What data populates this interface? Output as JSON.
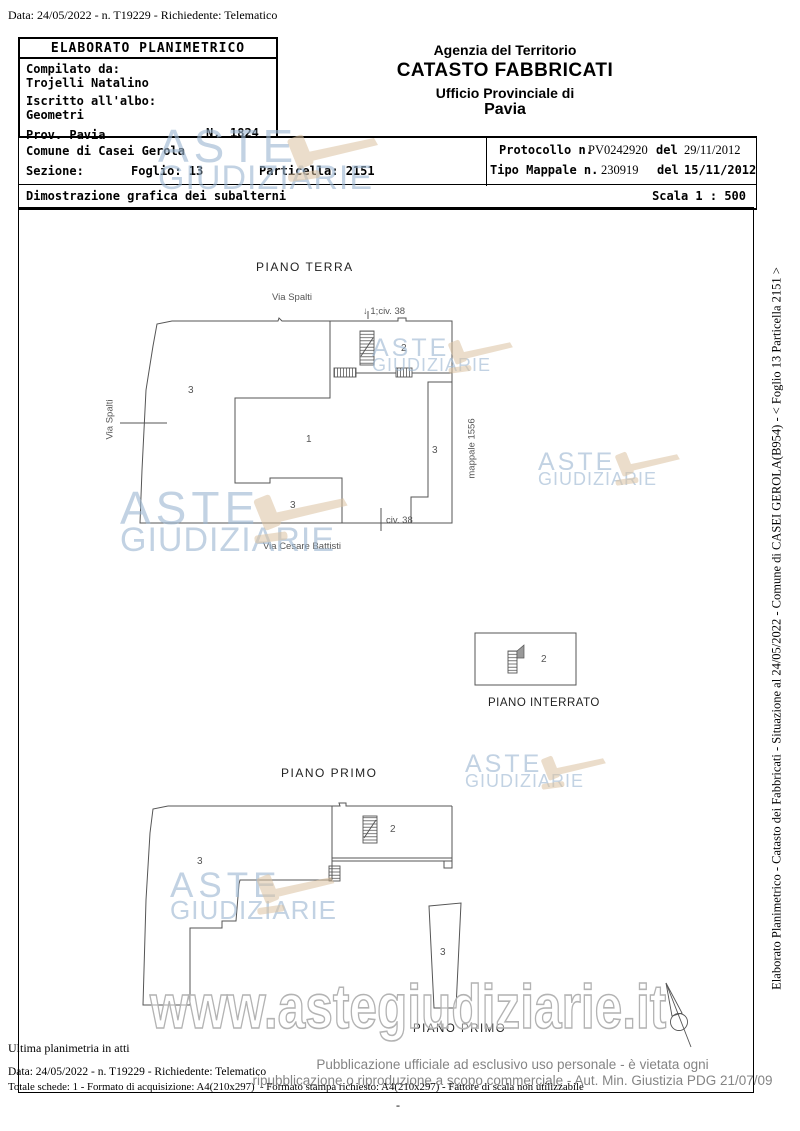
{
  "doc": {
    "top_line": "Data: 24/05/2022 - n. T19229 - Richiedente: Telematico"
  },
  "header_box": {
    "title": "ELABORATO PLANIMETRICO",
    "compilato_label": "Compilato da:",
    "compilato_value": "Trojelli Natalino",
    "iscritto_label": "Iscritto all'albo:",
    "iscritto_value": "Geometri",
    "prov": "Prov. Pavia",
    "n_label": "N.",
    "n_value": "1824"
  },
  "agency": {
    "line1": "Agenzia del Territorio",
    "line2": "CATASTO FABBRICATI",
    "line3": "Ufficio Provinciale di",
    "line4": "Pavia"
  },
  "info": {
    "comune": "Comune di Casei Gerola",
    "sezione": "Sezione:",
    "foglio": "Foglio: 13",
    "particella": "Particella: 2151",
    "protocollo_label": "Protocollo n.",
    "protocollo_num": "PV0242920",
    "protocollo_del": "del",
    "protocollo_date": "29/11/2012",
    "tipo_label": "Tipo Mappale n.",
    "tipo_num": "230919",
    "tipo_del": "del",
    "tipo_date": "15/11/2012",
    "dimostrazione": "Dimostrazione grafica dei subalterni",
    "scala": "Scala 1 : 500"
  },
  "plans": {
    "terra": {
      "title": "PIANO TERRA",
      "street_top": "Via Spalti",
      "street_left": "Via Spalti",
      "arrow_down": "↓",
      "civ_top": "1;civ. 38",
      "room_left": "3",
      "room_center": "1",
      "room_top_right": "2",
      "room_right": "3",
      "room_bottom": "3",
      "mappale": "mappale 1556",
      "civ_bottom": "civ. 38",
      "street_bottom": "Via Cesare Battisti"
    },
    "interrato": {
      "title": "PIANO INTERRATO",
      "room": "2"
    },
    "primo": {
      "title": "PIANO PRIMO",
      "room_left": "3",
      "room_top_right": "2",
      "room_right": "3",
      "title_bottom": "PIANO PRIMO"
    }
  },
  "watermark": {
    "line1": "ASTE",
    "line2": "GIUDIZIARIE",
    "url": "www.astegiudiziarie.it",
    "blue": "#9db8d2",
    "tan": "#dcc3a1"
  },
  "sidebar_text": "Elaborato Planimetrico - Catasto dei Fabbricati - Situazione al 24/05/2022 - Comune di CASEI GEROLA(B954) - < Foglio 13 Particella 2151 >",
  "footer": {
    "ultima": "Ultima planimetria in atti",
    "data_line": "Data: 24/05/2022 - n. T19229 - Richiedente: Telematico",
    "totale_line": "Totale schede: 1 - Formato di acquisizione: A4(210x297)  - Formato stampa richiesto: A4(210x297) - Fattore di scala non utilizzabile",
    "legal_line1": "Pubblicazione ufficiale ad esclusivo uso personale - è vietata ogni",
    "legal_line2": "ripubblicazione o riproduzione a scopo commerciale - Aut. Min. Giustizia PDG 21/07/09",
    "dash": "-"
  }
}
